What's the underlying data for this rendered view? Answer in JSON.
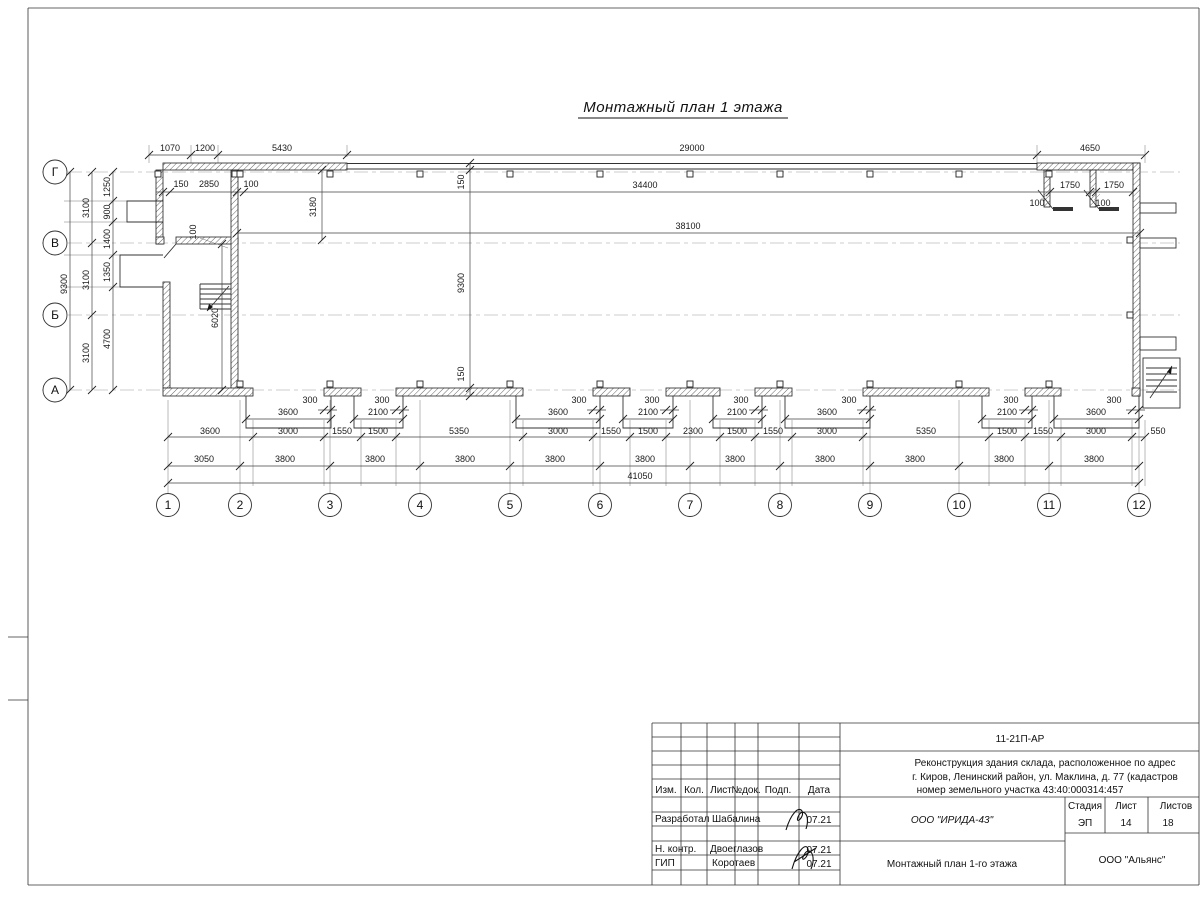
{
  "title": "Монтажный план 1 этажа",
  "plan": {
    "dims": {
      "top": [
        "1070",
        "1200",
        "5430",
        "29000",
        "4650"
      ],
      "it": [
        "150",
        "2850",
        "100",
        "34400",
        "1750",
        "1750",
        "100",
        "100",
        "38100"
      ],
      "lf": [
        "9300",
        "3100",
        "3100",
        "3100",
        "1250",
        "900",
        "1400",
        "1350",
        "4700"
      ],
      "il": [
        "3180",
        "100",
        "6020"
      ],
      "mid": [
        "150",
        "9300",
        "150"
      ],
      "g": [
        "3600",
        "2100",
        "3600",
        "2100",
        "2100",
        "3600",
        "2100",
        "3600"
      ],
      "p": "300",
      "r2": [
        "3600",
        "3000",
        "1550",
        "1500",
        "5350",
        "3000",
        "1550",
        "1500",
        "2300",
        "1500",
        "1550",
        "3000",
        "5350",
        "1500",
        "1550",
        "3000",
        "550"
      ],
      "r3": [
        "3050",
        "3800"
      ],
      "tot": "41050"
    },
    "axes": {
      "v": [
        "Г",
        "В",
        "Б",
        "А"
      ],
      "h": [
        "1",
        "2",
        "3",
        "4",
        "5",
        "6",
        "7",
        "8",
        "9",
        "10",
        "11",
        "12"
      ]
    }
  },
  "title_block": {
    "code": "11-21П-АР",
    "p1": "Реконструкция здания склада, расположенное по адрес",
    "p2": "г. Киров, Ленинский район, ул. Маклина, д. 77 (кадастров",
    "p3": "номер земельного участка 43:40:000314:457",
    "cols": [
      "Изм.",
      "Кол.",
      "Лист",
      "№док.",
      "Подп.",
      "Дата"
    ],
    "r1": "Разработал",
    "n1": "Шабалина",
    "r2": "Н. контр.",
    "n2": "Двоеглазов",
    "r3": "ГИП",
    "n3": "Коротаев",
    "date": "07.21",
    "company": "ООО \"ИРИДА-43\"",
    "sheet_title": "Монтажный план 1-го этажа",
    "stage_l": "Стадия",
    "sheet_l": "Лист",
    "sheets_l": "Листов",
    "stage": "ЭП",
    "sheet": "14",
    "sheets": "18",
    "org": "ООО \"Альянс\""
  }
}
